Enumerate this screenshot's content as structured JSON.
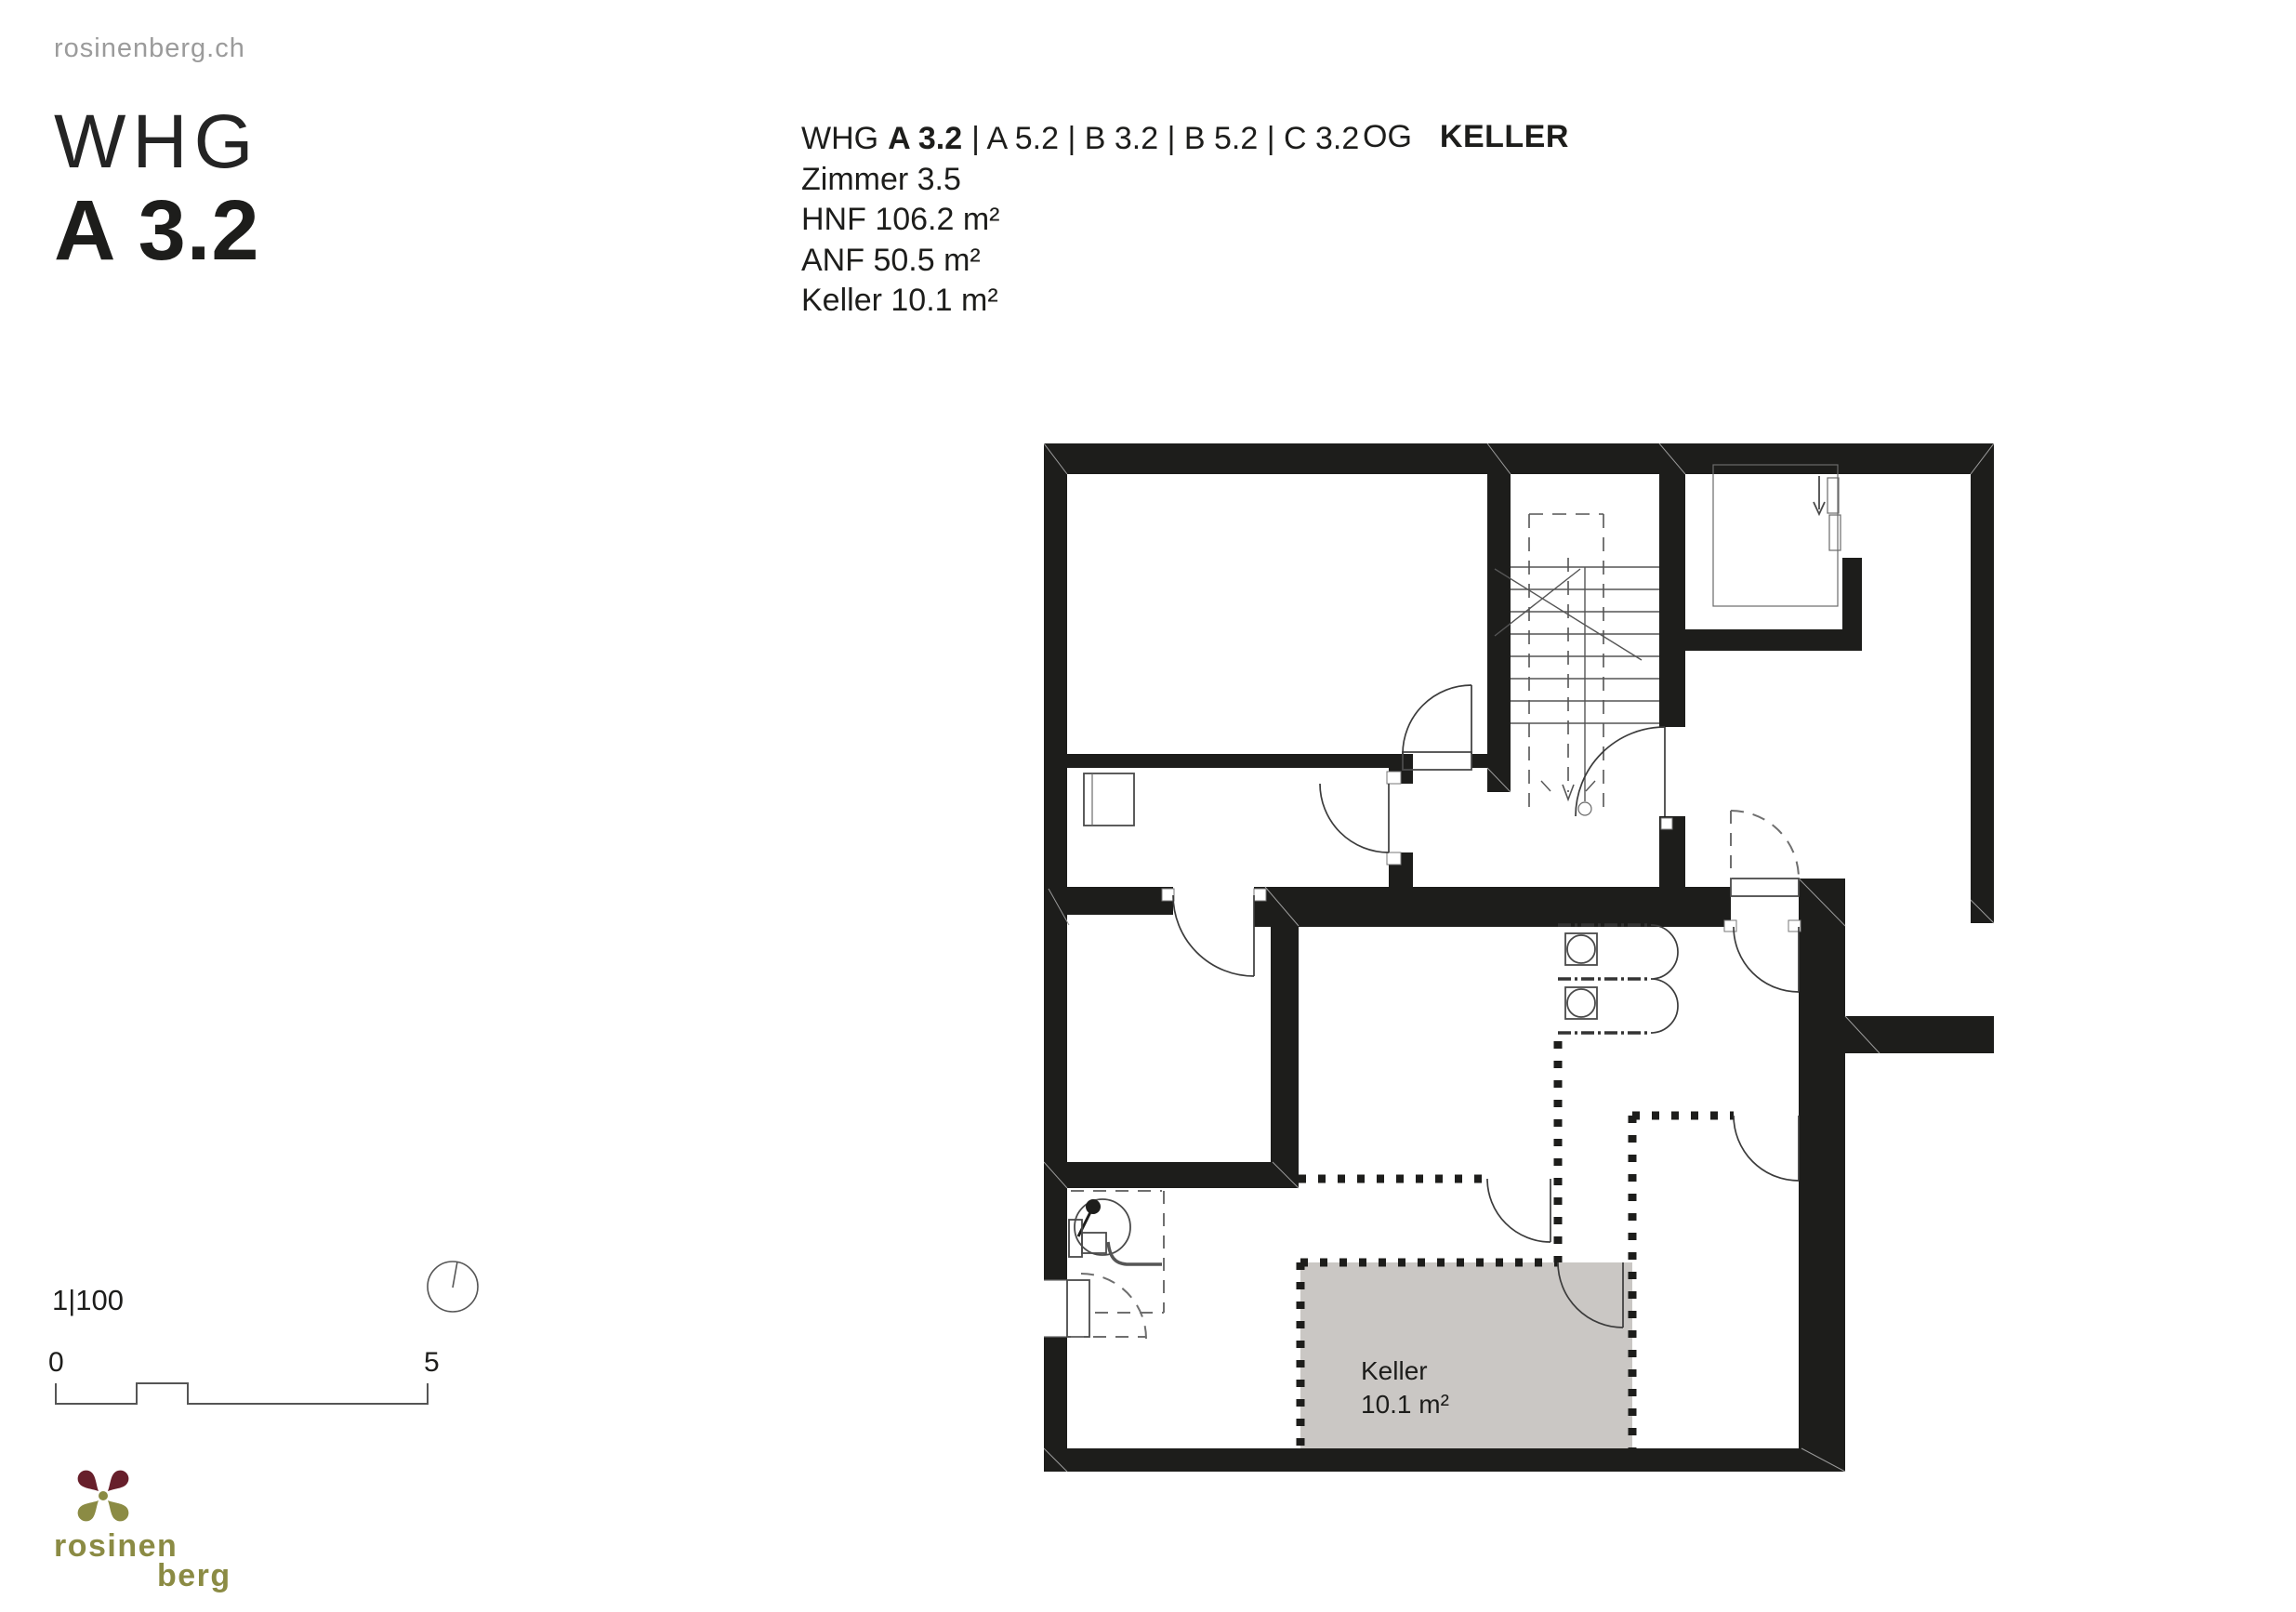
{
  "site": "rosinenberg.ch",
  "title": {
    "line1": "WHG",
    "line2": "A 3.2"
  },
  "info": {
    "whg_prefix": "WHG",
    "whg_current": "A 3.2",
    "whg_rest": "| A 5.2 | B 3.2 | B 5.2 | C 3.2",
    "rooms": "Zimmer 3.5",
    "hnf": "HNF 106.2 m²",
    "anf": "ANF 50.5 m²",
    "keller": "Keller 10.1 m²",
    "floor_label": "OG",
    "floor_value": "KELLER"
  },
  "plan": {
    "room_label": "Keller",
    "room_area": "10.1 m²",
    "highlight_color": "#cac7c4",
    "wall_color": "#1d1d1b"
  },
  "scalebar": {
    "ratio": "1|100",
    "start": "0",
    "end": "5"
  },
  "logo": {
    "word_top": "rosinen",
    "word_bottom": "berg",
    "color_olive": "#8b8b44",
    "color_maroon": "#671f2b"
  }
}
